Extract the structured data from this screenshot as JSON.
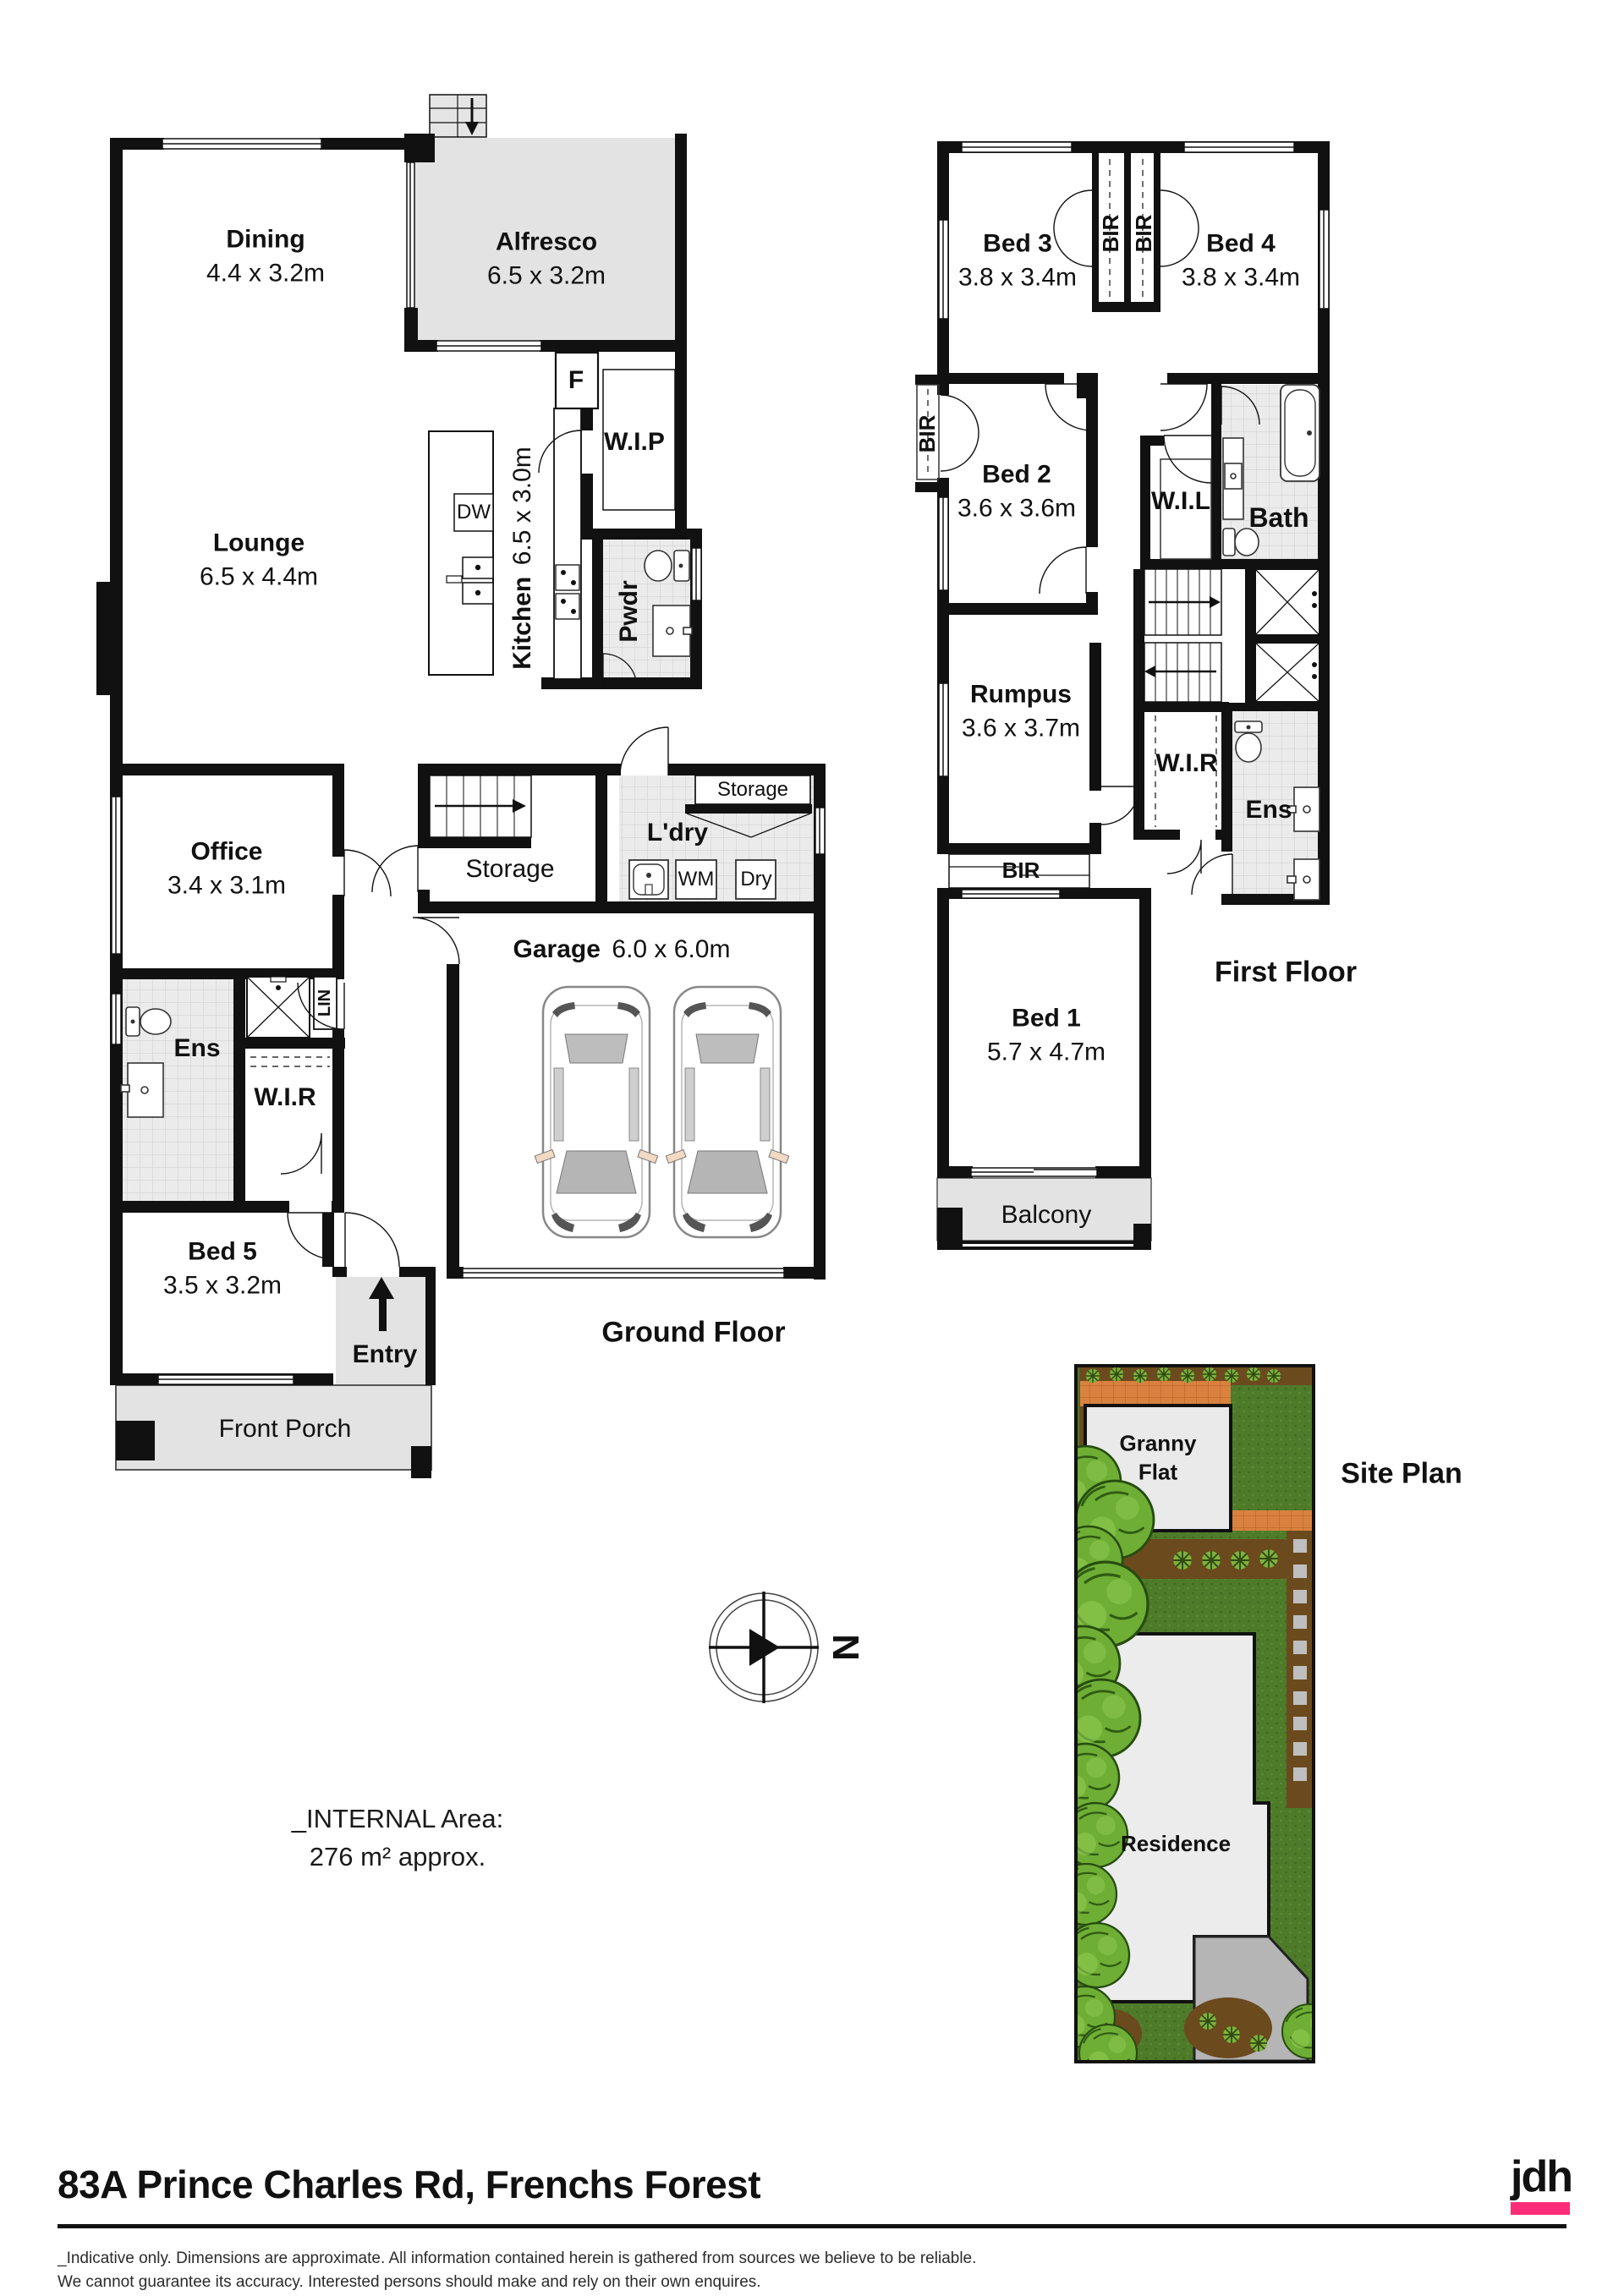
{
  "header": {
    "address": "83A Prince Charles Rd, Frenchs Forest"
  },
  "branding": {
    "logo_text": "jdh",
    "accent_color": "#FF2D78"
  },
  "footer": {
    "disclaimer_line1": "_Indicative only. Dimensions are approximate. All information contained herein is gathered from sources we believe to be reliable.",
    "disclaimer_line2": "We cannot guarantee its accuracy. Interested persons should make and rely on their own enquires."
  },
  "notes": {
    "internal_area_label": "_INTERNAL Area:",
    "internal_area_value": "276 m² approx."
  },
  "compass": {
    "north_label": "N"
  },
  "ground_floor": {
    "title": "Ground Floor",
    "rooms": {
      "dining": {
        "name": "Dining",
        "dims": "4.4 x 3.2m"
      },
      "alfresco": {
        "name": "Alfresco",
        "dims": "6.5 x 3.2m"
      },
      "lounge": {
        "name": "Lounge",
        "dims": "6.5 x 4.4m"
      },
      "kitchen": {
        "name": "Kitchen",
        "dims": "6.5 x 3.0m"
      },
      "wip": {
        "name": "W.I.P"
      },
      "pwdr": {
        "name": "Pwdr"
      },
      "office": {
        "name": "Office",
        "dims": "3.4 x 3.1m"
      },
      "storage_understairs": {
        "name": "Storage"
      },
      "storage_laundry": {
        "name": "Storage"
      },
      "laundry": {
        "name": "L'dry"
      },
      "garage": {
        "name": "Garage",
        "dims": "6.0 x 6.0m"
      },
      "ensuite": {
        "name": "Ens"
      },
      "linen": {
        "name": "LIN"
      },
      "wir": {
        "name": "W.I.R"
      },
      "bed5": {
        "name": "Bed 5",
        "dims": "3.5 x 3.2m"
      },
      "entry": {
        "name": "Entry"
      },
      "front_porch": {
        "name": "Front Porch"
      }
    },
    "appliances": {
      "fridge": "F",
      "dishwasher": "DW",
      "washing_machine": "WM",
      "dryer": "Dry"
    }
  },
  "first_floor": {
    "title": "First Floor",
    "rooms": {
      "bed3": {
        "name": "Bed 3",
        "dims": "3.8 x 3.4m"
      },
      "bir_bed3": {
        "name": "BIR"
      },
      "bir_bed4": {
        "name": "BIR"
      },
      "bed4": {
        "name": "Bed 4",
        "dims": "3.8 x 3.4m"
      },
      "bir_bed2": {
        "name": "BIR"
      },
      "bed2": {
        "name": "Bed 2",
        "dims": "3.6 x 3.6m"
      },
      "wil": {
        "name": "W.I.L"
      },
      "bath": {
        "name": "Bath"
      },
      "rumpus": {
        "name": "Rumpus",
        "dims": "3.6 x 3.7m"
      },
      "wir": {
        "name": "W.I.R"
      },
      "ensuite": {
        "name": "Ens"
      },
      "bir_bed1": {
        "name": "BIR"
      },
      "bed1": {
        "name": "Bed 1",
        "dims": "5.7 x 4.7m"
      },
      "balcony": {
        "name": "Balcony"
      }
    }
  },
  "site_plan": {
    "title": "Site Plan",
    "granny_flat_line1": "Granny",
    "granny_flat_line2": "Flat",
    "residence": "Residence"
  }
}
